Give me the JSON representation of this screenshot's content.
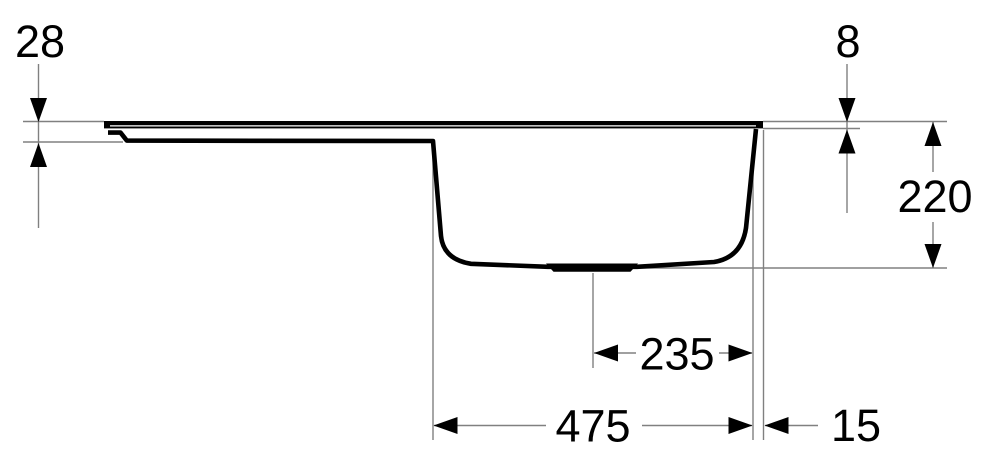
{
  "dimensions": {
    "left_edge_height": {
      "label": "28"
    },
    "rim_thickness": {
      "label": "8"
    },
    "bowl_depth": {
      "label": "220"
    },
    "drain_center_to_bowl_edge": {
      "label": "235"
    },
    "bowl_width": {
      "label": "475"
    },
    "bowl_edge_to_rim_edge": {
      "label": "15"
    }
  },
  "colors": {
    "bg": "#ffffff",
    "line": "#000000",
    "dim": "#808080",
    "text": "#000000"
  }
}
